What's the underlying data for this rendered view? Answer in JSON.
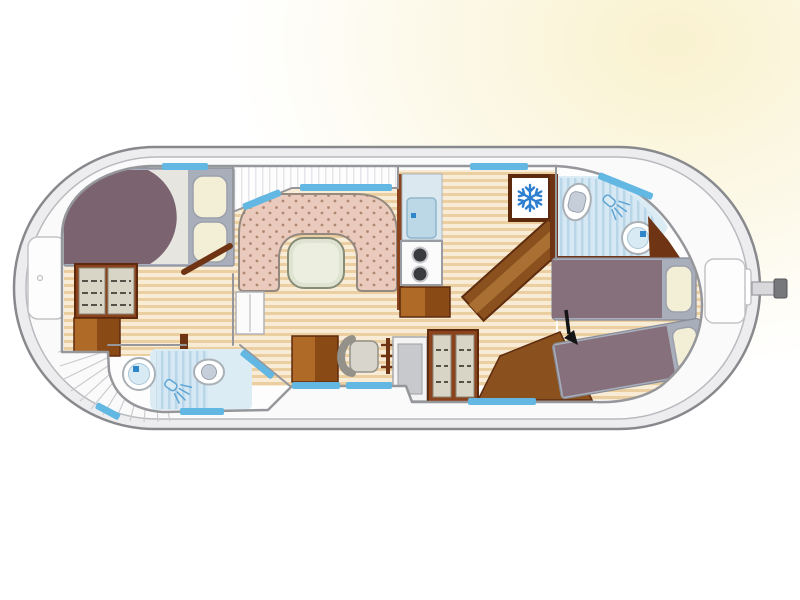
{
  "scene": {
    "type": "boat-deck-floorplan",
    "subject": "canal-houseboat interior layout",
    "view": "top-down",
    "visible_text": ""
  },
  "colors": {
    "glow": "#f8efc6",
    "hull_fill": "#ededef",
    "hull_line": "#88898d",
    "deck_fill": "#fafafb",
    "deck_line": "#b9babe",
    "fan_line": "#c9c9cd",
    "wall": "#96979b",
    "cabin_fill": "#fdfdfe",
    "hatch": "#e6e6ea",
    "wood_light": "#f8ecd6",
    "wood_dark": "#eccfa0",
    "window": "#62b7e3",
    "door_brown": "#6e3413",
    "wardrobe_frame": "#8a431c",
    "wardrobe_edge": "#5e2a0e",
    "wardrobe_door": "#d8d5c6",
    "wardrobe_door_edge": "#8b8878",
    "shelf_line": "#55524a",
    "cabinet_light": "#b06a28",
    "cabinet_dark": "#8a4a16",
    "bed_frame": "#a9aebb",
    "bed_frame_line": "#878c99",
    "duvet_front": "#7b6470",
    "duvet_stern": "#86707c",
    "sheet": "#e7e5df",
    "pillow": "#f3eed6",
    "pillow_line": "#9aa0ac",
    "sofa": "#e9cabc",
    "sofa_dot": "#b28772",
    "sofa_line": "#94897f",
    "table_fill": "#dfe4d2",
    "table_inner": "#ecefe0",
    "table_line": "#878c78",
    "tile_light": "#dcecf5",
    "tile_bg": "#d6e8f3",
    "tile_stripe": "#b9d6e8",
    "fixture_line": "#aab0b6",
    "basin": "#d8eaf4",
    "toilet_lid": "#c6cfd9",
    "faucet_blue": "#2f86c8",
    "shower_blue": "#5ea4d4",
    "snowflake": "#2e7fd0",
    "stove_body": "#fbfbfc",
    "stove_line": "#999ca0",
    "burner": "#3a3b3f",
    "counter": "#dce8ef",
    "sink_basin": "#bcd8e6",
    "sink_edge": "#8fb6cc",
    "console_fill": "#f4f4f5",
    "console_inner": "#c7c9cc",
    "chair_fill": "#d8d5cd",
    "chair_line": "#94918a",
    "stairs": "#8a511f",
    "stairs_light": "#a96f33",
    "stairs_edge": "#5e2c0e",
    "arrow": "#151515",
    "tiller": "#d9d9dc",
    "tiller_cap": "#77787c",
    "white_box": "#fbfbfc",
    "white_box_line": "#b2b3b6"
  },
  "icons": [
    {
      "name": "snowflake-icon",
      "meaning": "refrigerator",
      "glyph": "snowflake",
      "color": "#2e7fd0"
    },
    {
      "name": "shower-icon",
      "meaning": "shower spray",
      "count": 2,
      "color": "#5ea4d4"
    },
    {
      "name": "entrance-arrow-icon",
      "meaning": "entry direction",
      "color": "#151515"
    }
  ],
  "rooms": [
    {
      "name": "bow-cabin",
      "features": [
        "double-bed",
        "wardrobe",
        "cabinet",
        "open-door"
      ]
    },
    {
      "name": "bathroom-port-forward",
      "features": [
        "washbasin",
        "toilet",
        "shower-tiles",
        "shower-icon"
      ]
    },
    {
      "name": "salon",
      "features": [
        "u-shaped-settee",
        "table",
        "low-cabinet"
      ]
    },
    {
      "name": "helm-station",
      "features": [
        "helm-chair",
        "steering-wheel",
        "console",
        "cabinet",
        "shelved-wardrobe"
      ]
    },
    {
      "name": "galley",
      "features": [
        "sink",
        "two-burner-stove",
        "counter",
        "refrigerator-snowflake",
        "companionway-stairs"
      ]
    },
    {
      "name": "bathroom-starboard-aft",
      "features": [
        "toilet",
        "shower-icon",
        "washbasin",
        "shower-tiles"
      ]
    },
    {
      "name": "stern-cabin",
      "features": [
        "single-bed-upper",
        "single-bed-angled",
        "pillows",
        "wood-berth-base"
      ]
    }
  ],
  "deck_features": [
    "bow-locker",
    "stern-locker",
    "radial-bow-deck-planking",
    "tiller",
    "hull-windows"
  ]
}
